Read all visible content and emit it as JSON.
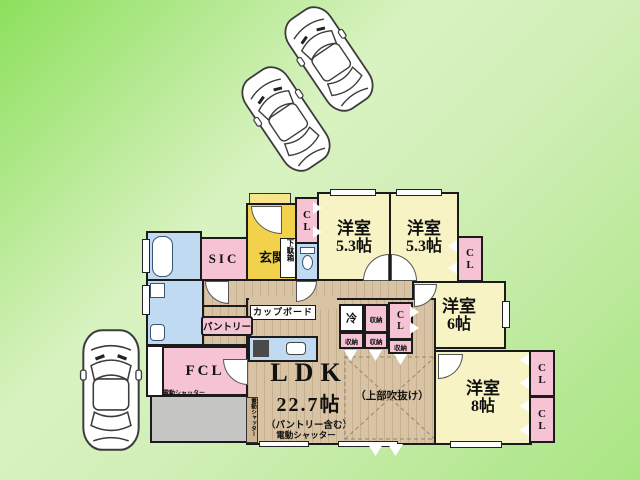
{
  "colors": {
    "wall": "#1b1b1b",
    "room_cream": "#f8f3c4",
    "entrance_gold": "#f2d24b",
    "closet_pink": "#f6c3d5",
    "water_blue": "#c0dbf1",
    "wood_floor": "#d8c4a5",
    "terrace_gray": "#c5c5c3",
    "background_green": "#a9e583"
  },
  "labels": {
    "bedroom": "洋室",
    "size_53": "5.3帖",
    "size_6": "6帖",
    "size_8": "8帖",
    "ldk": "LDK",
    "ldk_size": "22.7帖",
    "ldk_note_pantry": "（パントリー含む）",
    "ldk_note_void": "（上部吹抜け）",
    "entrance": "玄関",
    "shoe_box": "下駄箱",
    "sic": "SIC",
    "fcl": "FCL",
    "pantry": "パントリー",
    "cupboard": "カップボード",
    "closet": "CL",
    "storage": "収納",
    "fridge": "冷",
    "shutter": "電動シャッター"
  }
}
